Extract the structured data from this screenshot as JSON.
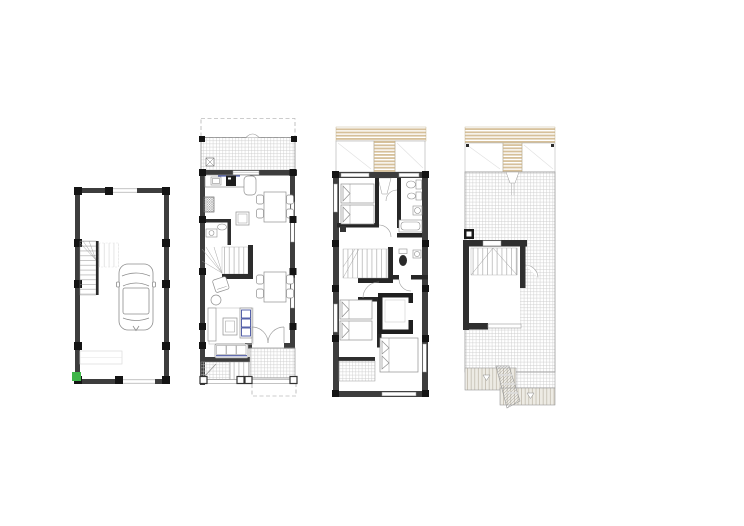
{
  "canvas": {
    "width": 744,
    "height": 526,
    "background": "#ffffff"
  },
  "colors": {
    "outer_wall": "#3d3d3d",
    "partition_wall": "#232323",
    "column": "#141414",
    "light_line": "#9b9b9b",
    "furniture_line": "#8f8f8f",
    "tile_grid_line": "#cbcbcb",
    "pergola_tan": "#d6c09a",
    "awning_fill": "#edebe4",
    "awning_line": "#b5ae9e",
    "accent_navy": "#2e3d96",
    "marker_green": "#3fb549"
  },
  "plans": [
    {
      "id": "basement-garage",
      "features": [
        "perimeter-walls-with-columns",
        "staircase",
        "parked-car",
        "garage-door-opening",
        "green-corner-marker"
      ]
    },
    {
      "id": "ground-floor",
      "features": [
        "dashed-plot-line",
        "front-tiled-terrace",
        "kitchen-with-sink-and-stove",
        "service-shaft",
        "wc",
        "winder-staircase",
        "living-room-sofa-and-tv",
        "two-dining-tables",
        "french-doors",
        "rear-tiled-patio",
        "entry-steps"
      ]
    },
    {
      "id": "first-floor",
      "features": [
        "pergola-slats",
        "bedroom-1-twin-beds",
        "bathroom-1-with-bathtub",
        "staircase",
        "bathroom-2",
        "walk-in-closet",
        "bedroom-2-twin-beds",
        "tiled-balcony",
        "bedroom-3-double-bed"
      ]
    },
    {
      "id": "roof-terrace",
      "features": [
        "pergola-slats",
        "tiled-roof-terrace",
        "stair-enclosure-with-door",
        "service-box",
        "lower-roof-awnings",
        "external-stepped-stair"
      ]
    }
  ]
}
